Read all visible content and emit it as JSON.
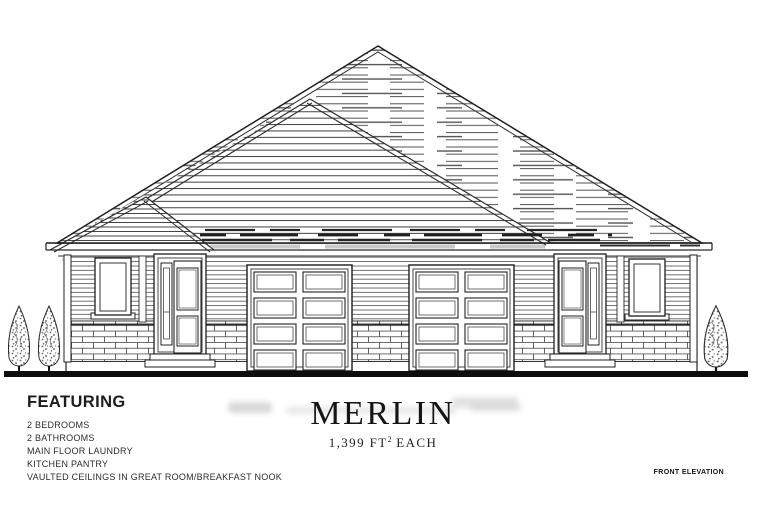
{
  "document": {
    "plan_name": "MERLIN",
    "area": {
      "value_unit": "1,399 FT",
      "superscript": "2",
      "suffix": "EACH"
    },
    "featuring": {
      "heading": "FEATURING",
      "items": [
        "2 BEDROOMS",
        "2 BATHROOMS",
        "MAIN FLOOR LAUNDRY",
        "KITCHEN PANTRY",
        "VAULTED CEILINGS IN GREAT ROOM/BREAKFAST NOOK"
      ]
    },
    "view_label": "FRONT ELEVATION"
  },
  "colors": {
    "ink": "#222222",
    "ground_line": "#0d0d0d",
    "paper": "#ffffff"
  }
}
